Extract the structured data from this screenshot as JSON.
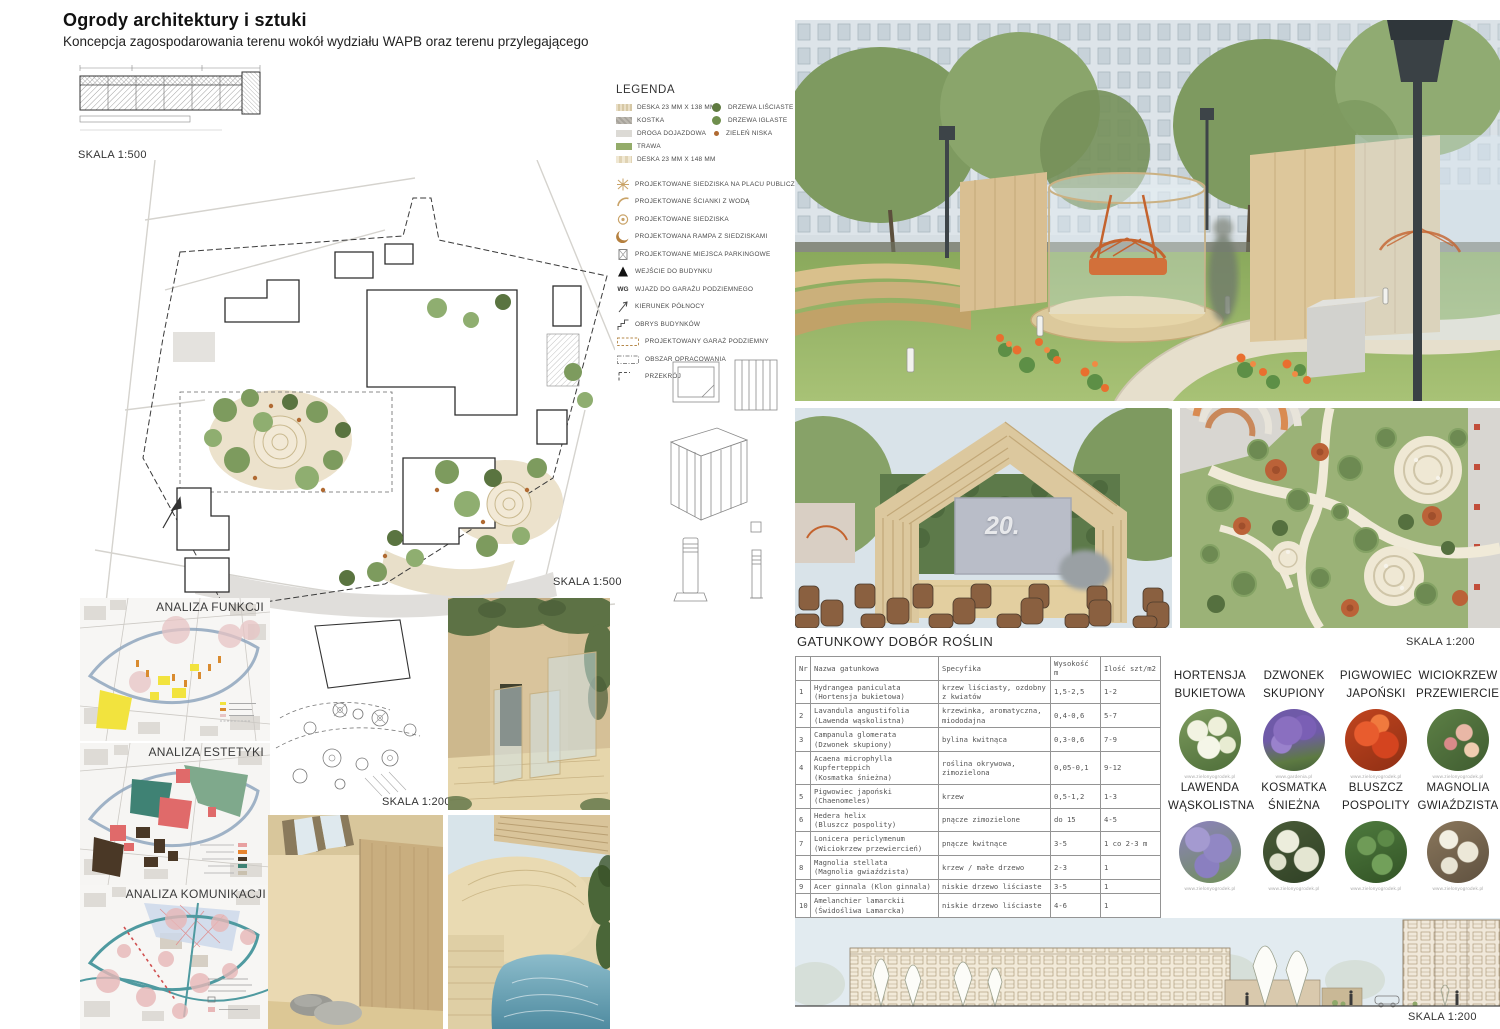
{
  "poster": {
    "title": "Ogrody architektury i sztuki",
    "subtitle": "Koncepcja zagospodarowania terenu wokół wydziału WAPB oraz terenu przylegającego"
  },
  "scales": {
    "top_strip": "SKALA 1:500",
    "main_plan": "SKALA 1:500",
    "detail_plan": "SKALA 1:200",
    "right_plan": "SKALA 1:200",
    "elevation": "SKALA 1:200"
  },
  "legend": {
    "title": "LEGENDA",
    "materials": [
      {
        "label": "DESKA 23 MM X 138 MM",
        "swatch_style": "background:repeating-linear-gradient(90deg,#e9dec6 0 2px,#d6c8a5 2px 4px)"
      },
      {
        "label": "KOSTKA",
        "swatch_style": "background:repeating-linear-gradient(45deg,#bdb9b1 0 2px,#a8a49c 2px 4px)"
      },
      {
        "label": "DROGA DOJAZDOWA",
        "swatch_style": "background:#dcdad5"
      },
      {
        "label": "TRAWA",
        "swatch_style": "background:#94ac6a"
      },
      {
        "label": "DESKA 23 MM X 148 MM",
        "swatch_style": "background:repeating-linear-gradient(90deg,#f0e8d3 0 3px,#e0d3b4 3px 6px)"
      }
    ],
    "vegetation": [
      {
        "label": "DRZEWA LIŚCIASTE",
        "swatch_style": "background:#5f7a40"
      },
      {
        "label": "DRZEWA IGLASTE",
        "swatch_style": "background:#6f8f4d"
      },
      {
        "label": "ZIELEŃ NISKA",
        "swatch_style": "background:#b06a32;width:5px;height:5px;margin-left:2px"
      }
    ],
    "symbols": [
      {
        "label": "PROJEKTOWANE SIEDZISKA NA PLACU PUBLICZNYM"
      },
      {
        "label": "PROJEKTOWANE ŚCIANKI Z WODĄ"
      },
      {
        "label": "PROJEKTOWANE SIEDZISKA"
      },
      {
        "label": "PROJEKTOWANA RAMPA Z SIEDZISKAMI"
      },
      {
        "label": "PROJEKTOWANE MIEJSCA PARKINGOWE"
      },
      {
        "label": "WEJŚCIE DO BUDYNKU"
      },
      {
        "label": "WJAZD DO GARAŻU PODZIEMNEGO",
        "icon_text": "WG"
      },
      {
        "label": "KIERUNEK PÓŁNOCY"
      },
      {
        "label": "OBRYS BUDYNKÓW"
      },
      {
        "label": "PROJEKTOWANY GARAŻ PODZIEMNY"
      },
      {
        "label": "OBSZAR OPRACOWANIA"
      },
      {
        "label": "PRZEKRÓJ"
      }
    ]
  },
  "analyses": {
    "items": [
      {
        "title": "ANALIZA FUNKCJI"
      },
      {
        "title": "ANALIZA ESTETYKI"
      },
      {
        "title": "ANALIZA KOMUNIKACJI"
      }
    ]
  },
  "stage": {
    "screen_text": "20."
  },
  "plant_table": {
    "title": "GATUNKOWY DOBÓR ROŚLIN",
    "columns": {
      "nr": "Nr",
      "name": "Nazwa gatunkowa",
      "spec": "Specyfika",
      "height": "Wysokość m",
      "qty": "Ilość szt/m2"
    },
    "rows": [
      {
        "nr": "1",
        "name": "Hydrangea paniculata",
        "name2": "(Hortensja bukietowa)",
        "spec": "krzew liściasty, ozdobny z kwiatów",
        "h": "1,5-2,5",
        "q": "1-2"
      },
      {
        "nr": "2",
        "name": "Lavandula angustifolia",
        "name2": "(Lawenda wąskolistna)",
        "spec": "krzewinka, aromatyczna, miododajna",
        "h": "0,4-0,6",
        "q": "5-7"
      },
      {
        "nr": "3",
        "name": "Campanula glomerata",
        "name2": "(Dzwonek skupiony)",
        "spec": "bylina kwitnąca",
        "h": "0,3-0,6",
        "q": "7-9"
      },
      {
        "nr": "4",
        "name": "Acaena microphylla Kupferteppich",
        "name2": "(Kosmatka śnieżna)",
        "spec": "roślina okrywowa, zimozielona",
        "h": "0,05-0,1",
        "q": "9-12"
      },
      {
        "nr": "5",
        "name": "Pigwowiec japoński",
        "name2": "(Chaenomeles)",
        "spec": "krzew",
        "h": "0,5-1,2",
        "q": "1-3"
      },
      {
        "nr": "6",
        "name": "Hedera helix",
        "name2": "(Bluszcz pospolity)",
        "spec": "pnącze zimozielone",
        "h": "do 15",
        "q": "4-5"
      },
      {
        "nr": "7",
        "name": "Lonicera periclymenum",
        "name2": "(Wiciokrzew przewiercień)",
        "spec": "pnącze kwitnące",
        "h": "3-5",
        "q": "1 co 2-3 m"
      },
      {
        "nr": "8",
        "name": "Magnolia stellata",
        "name2": "(Magnolia gwiaździsta)",
        "spec": "krzew / małe drzewo",
        "h": "2-3",
        "q": "1"
      },
      {
        "nr": "9",
        "name": "Acer ginnala (Klon ginnala)",
        "name2": "",
        "spec": "niskie drzewo liściaste",
        "h": "3-5",
        "q": "1"
      },
      {
        "nr": "10",
        "name": "Amelanchier lamarckii",
        "name2": "(Świdośliwa Lamarcka)",
        "spec": "niskie drzewo liściaste",
        "h": "4-6",
        "q": "1"
      },
      {
        "nr": "11",
        "name": "Thuja occidentalis",
        "name2": "(Żywotnik zachodni)",
        "spec": "niskie drzewo iglaste",
        "h": "3-5",
        "q": "1"
      }
    ]
  },
  "plants_gallery": {
    "items": [
      {
        "line1": "HORTENSJA",
        "line2": "BUKIETOWA",
        "caption": "www.zielonyogrodek.pl",
        "photo_style": "background:radial-gradient(circle at 30% 35%, #f2f3e2 0 10px, rgba(0,0,0,0) 11px),radial-gradient(circle at 62% 28%, #eef0da 0 9px, rgba(0,0,0,0) 10px),radial-gradient(circle at 48% 62%, #f5f6e8 0 11px, rgba(0,0,0,0) 12px),radial-gradient(circle at 78% 58%, #e8ecd2 0 8px, rgba(0,0,0,0) 9px),linear-gradient(160deg,#7d9b5e,#4f6f3a)"
      },
      {
        "line1": "DZWONEK",
        "line2": "SKUPIONY",
        "caption": "www.gardenia.pl",
        "photo_style": "background:radial-gradient(circle at 40% 35%, #8a6fc0 0 14px, rgba(0,0,0,0) 15px),radial-gradient(circle at 66% 30%, #7a5fb5 0 12px, rgba(0,0,0,0) 13px),radial-gradient(circle at 30% 55%, #9a82cc 0 10px, rgba(0,0,0,0) 11px),linear-gradient(170deg,#6f5aa8 45%,#5d7a42 78%,#46603a)"
      },
      {
        "line1": "PIGWOWIEC",
        "line2": "JAPOŃSKI",
        "caption": "www.zielonyogrodek.pl",
        "photo_style": "background:radial-gradient(circle at 35% 40%, #e85c2e 0 12px, rgba(0,0,0,0) 13px),radial-gradient(circle at 65% 58%, #d4441f 0 13px, rgba(0,0,0,0) 14px),radial-gradient(circle at 56% 24%, #f07a3e 0 9px, rgba(0,0,0,0) 10px),linear-gradient(150deg,#c1451f,#8f2f14)"
      },
      {
        "line1": "WICIOKRZEW",
        "line2": "PRZEWIERCIEŃ",
        "caption": "www.zielonyogrodek.pl",
        "photo_style": "background:radial-gradient(circle at 60% 38%, #e9b7a6 0 8px, rgba(0,0,0,0) 9px),radial-gradient(circle at 72% 66%, #f0cdb0 0 7px, rgba(0,0,0,0) 8px),radial-gradient(circle at 38% 56%, #d98a8a 0 6px, rgba(0,0,0,0) 7px),linear-gradient(140deg,#5d8046,#3f5c30)"
      },
      {
        "line1": "LAWENDA",
        "line2": "WĄSKOLISTNA",
        "caption": "www.zielonyogrodek.pl",
        "photo_style": "background:radial-gradient(circle at 30% 30%, #a49ad0 0 12px, rgba(0,0,0,0) 13px),radial-gradient(circle at 62% 44%, #9187c4 0 14px, rgba(0,0,0,0) 15px),radial-gradient(circle at 45% 72%, #8a7fc0 0 12px, rgba(0,0,0,0) 13px),linear-gradient(160deg,#8d82bf,#6f8f57)"
      },
      {
        "line1": "KOSMATKA",
        "line2": "ŚNIEŻNA",
        "caption": "www.zielonyogrodek.pl",
        "photo_style": "background:radial-gradient(circle at 40% 33%, #eceddc 0 11px, rgba(0,0,0,0) 12px),radial-gradient(circle at 70% 62%, #e4e6d2 0 12px, rgba(0,0,0,0) 13px),radial-gradient(circle at 24% 66%, #dfe2cc 0 8px, rgba(0,0,0,0) 9px),linear-gradient(150deg,#4a5c38,#2f4025)"
      },
      {
        "line1": "BLUSZCZ",
        "line2": "POSPOLITY",
        "caption": "www.zielonyogrodek.pl",
        "photo_style": "background:radial-gradient(circle at 35% 40%, #6f9b57 0 9px, rgba(0,0,0,0) 10px),radial-gradient(circle at 66% 28%, #5d8a48 0 8px, rgba(0,0,0,0) 9px),radial-gradient(circle at 60% 70%, #72a05a 0 10px, rgba(0,0,0,0) 11px),linear-gradient(160deg,#4e7a3e,#335426)"
      },
      {
        "line1": "MAGNOLIA",
        "line2": "GWIAŹDZISTA",
        "caption": "www.zielonyogrodek.pl",
        "photo_style": "background:radial-gradient(circle at 35% 30%, #f2efe2 0 9px, rgba(0,0,0,0) 10px),radial-gradient(circle at 66% 50%, #ece8d8 0 10px, rgba(0,0,0,0) 11px),radial-gradient(circle at 36% 72%, #e8e4d4 0 8px, rgba(0,0,0,0) 9px),linear-gradient(150deg,#8a775c,#5f5140)"
      }
    ]
  },
  "colors": {
    "wood": "#d9c49a",
    "accent_orange": "#e8703a",
    "grass": "#8aa95c",
    "sky": "#d6dee3",
    "table_text": "#555555"
  }
}
